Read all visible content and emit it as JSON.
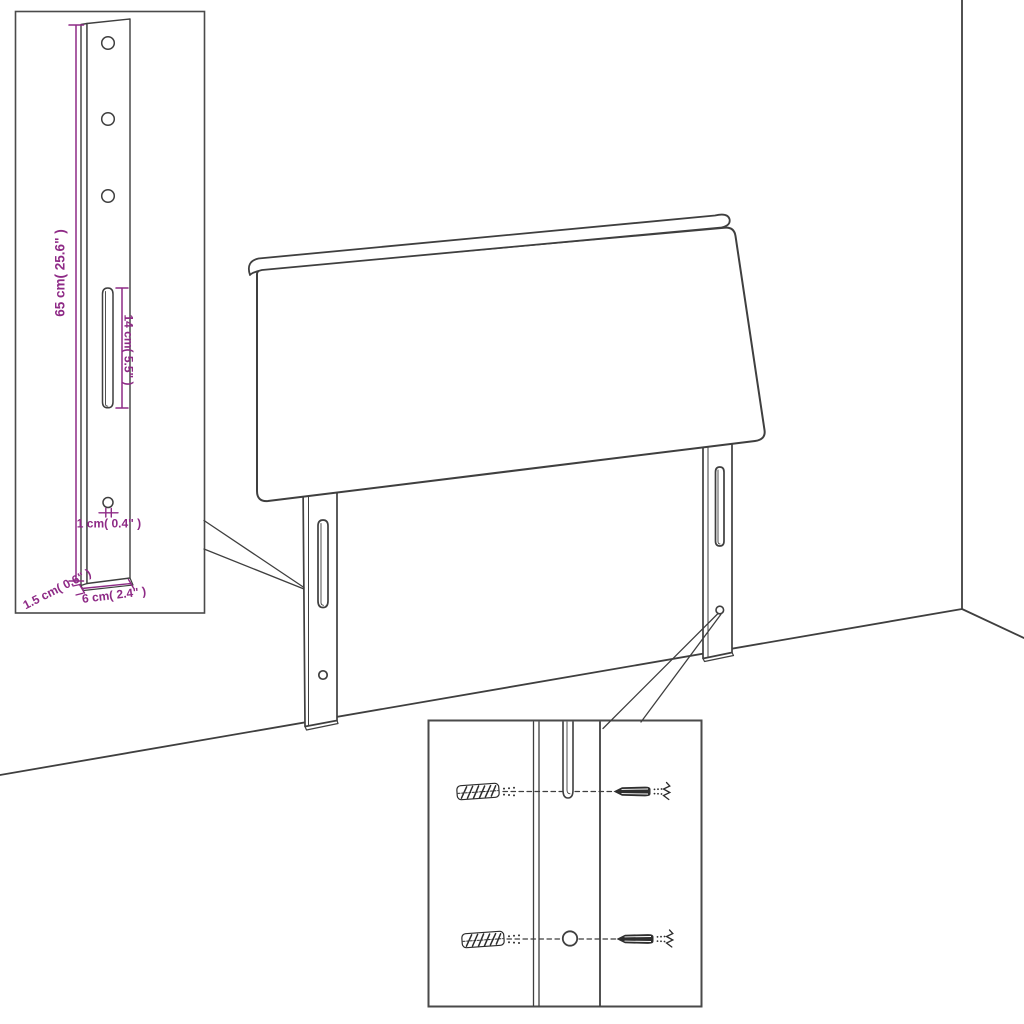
{
  "colors": {
    "background": "#ffffff",
    "line": "#3f3f3f",
    "inset_border": "#4a4a4a",
    "accent": "#8e2a86"
  },
  "insets": {
    "bracket_detail": {
      "height_label": "65 cm( 25.6\" )",
      "slot_label": "14 cm( 5.5\" )",
      "hole_label": "1 cm( 0.4\" )",
      "thickness_label": "1.5 cm( 0.6\" )",
      "width_label": "6 cm( 2.4\" )"
    }
  }
}
